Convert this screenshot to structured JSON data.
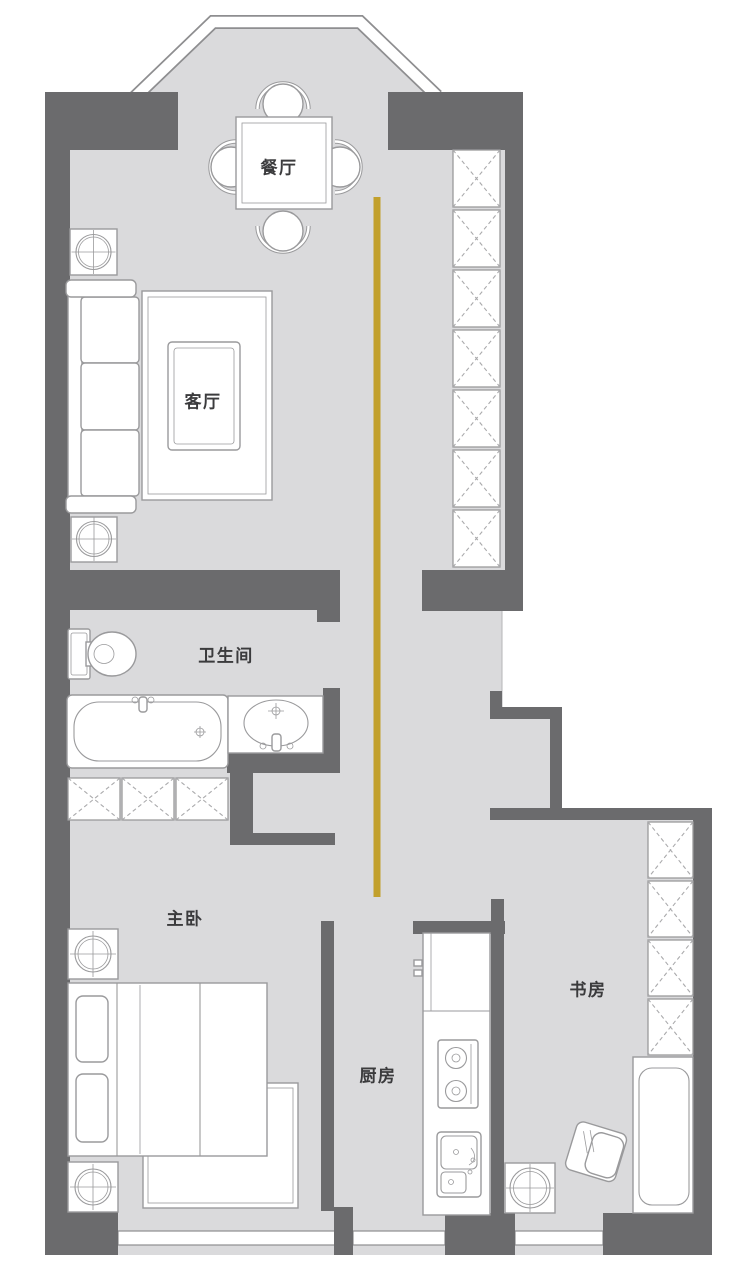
{
  "rooms": {
    "dining": {
      "label": "餐厅"
    },
    "living": {
      "label": "客厅"
    },
    "bathroom": {
      "label": "卫生间"
    },
    "master_bedroom": {
      "label": "主卧"
    },
    "kitchen": {
      "label": "厨房"
    },
    "study": {
      "label": "书房"
    }
  },
  "colors": {
    "wall": "#6b6b6d",
    "floor": "#dadadc",
    "furniture_fill": "#ffffff",
    "furniture_outline": "#9a9a9c",
    "hatch": "#aaaaac",
    "window_outline": "#8e8e90",
    "pattern_line": "#c7c7c9",
    "accent_line": "#c2a02c",
    "label_text": "#3b3b3d"
  }
}
